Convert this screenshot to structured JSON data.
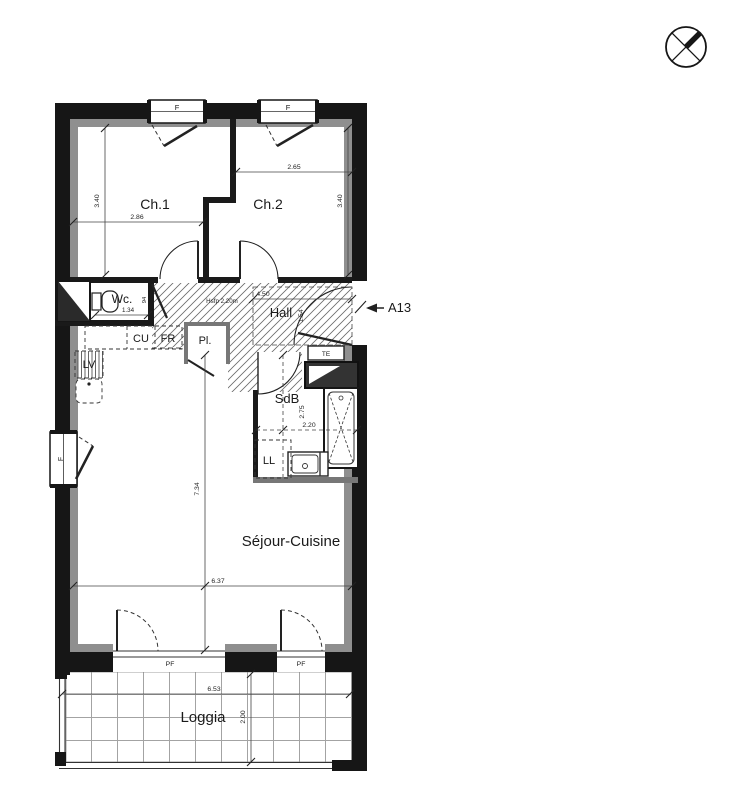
{
  "plan": {
    "apartment_label": "A13",
    "rooms": {
      "ch1": {
        "name": "Ch.1",
        "width": "2.86",
        "depth": "3.40"
      },
      "ch2": {
        "name": "Ch.2",
        "width": "2.65",
        "depth": "3.40"
      },
      "wc": {
        "name": "Wc.",
        "width": "1.34",
        "depth": "94"
      },
      "hall": {
        "name": "Hall",
        "width": "4.50",
        "depth": "1.54",
        "ceiling_note": "Hsfp 2.20m"
      },
      "sdb": {
        "name": "SdB",
        "length": "2.75",
        "width": "2.20"
      },
      "sejour": {
        "name": "Séjour-Cuisine",
        "length": "7.34",
        "width": "6.37"
      },
      "loggia": {
        "name": "Loggia",
        "width": "6.53",
        "depth": "2.00"
      }
    },
    "fixtures": {
      "cu": "CU",
      "fr": "FR",
      "lv": "LV",
      "ll": "LL",
      "pl": "Pl.",
      "te": "TE"
    },
    "openings": {
      "window_label": "F",
      "french_window_label": "PF"
    },
    "icons": {
      "compass": "north-compass-crossed-circle"
    },
    "colors": {
      "wall": "#161616",
      "lining": "#8f8f8f",
      "hatch": "#6a6a6a"
    }
  }
}
